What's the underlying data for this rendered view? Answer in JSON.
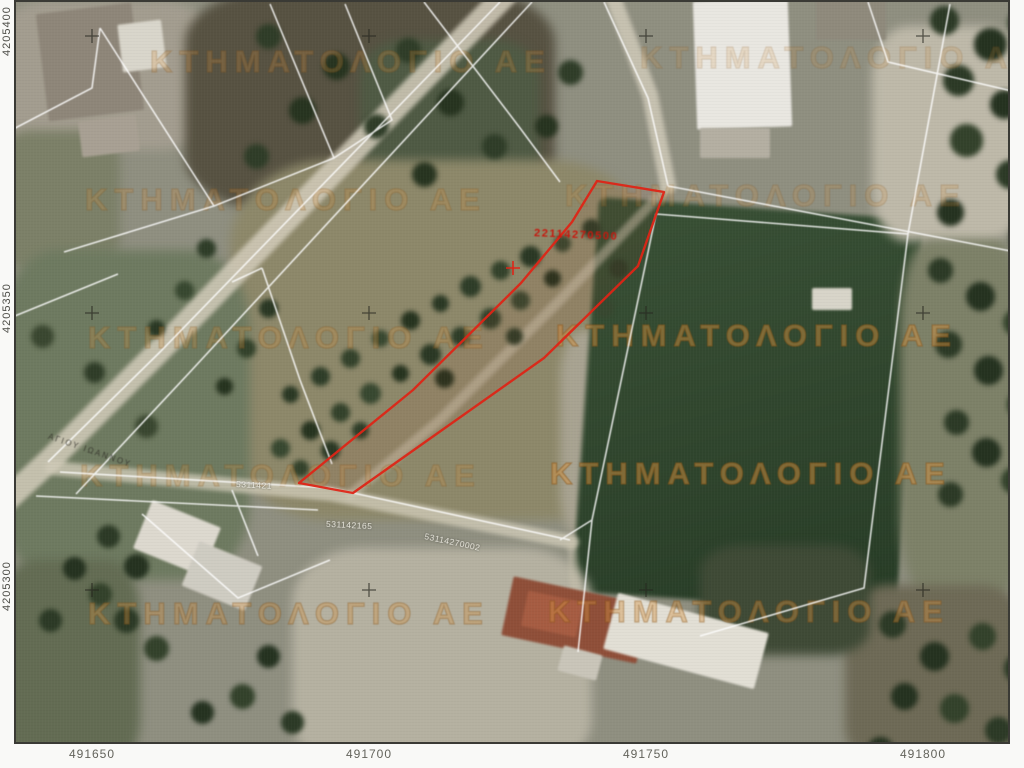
{
  "cadastral_viewer": {
    "watermark": {
      "text": "ΚΤΗΜΑΤΟΛΟΓΙΟ ΑΕ",
      "color": "#d39242"
    },
    "axis": {
      "x_ticks": [
        "491650",
        "491700",
        "491750",
        "491800"
      ],
      "y_ticks": [
        "4205400",
        "4205350",
        "4205300"
      ]
    },
    "selected_parcel": {
      "code": "22114270500",
      "outline_color": "#de2517"
    },
    "parcel_labels": [
      "531142165",
      "53114270002",
      "5311421"
    ],
    "road_label": "ΑΓΙΟΥ ΙΩΑΝΝΟΥ",
    "boundary_color": "#ffffff"
  }
}
